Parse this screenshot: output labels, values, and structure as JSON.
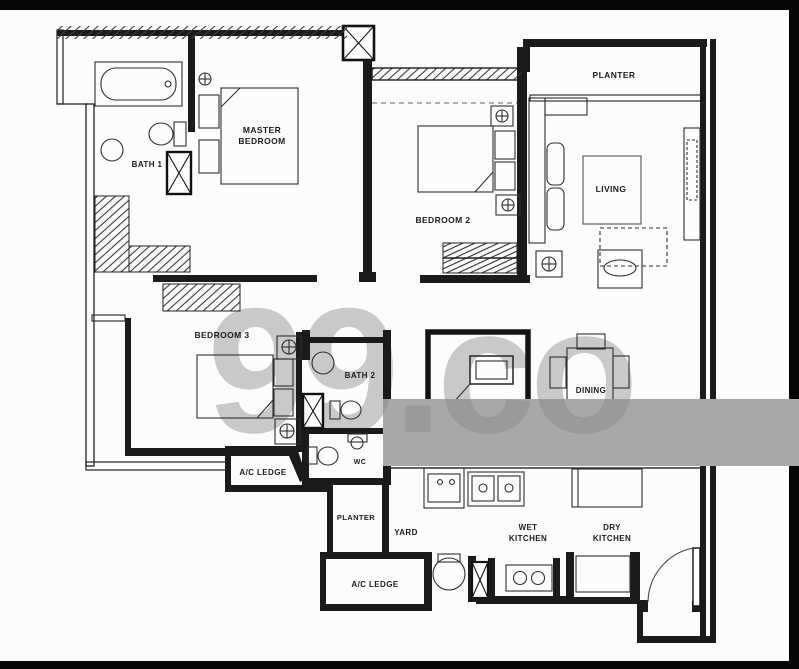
{
  "title": "apartment-floor-plan",
  "watermark": {
    "text": "99.co"
  },
  "colors": {
    "band": "#a9a9a9",
    "watermark_light": "#c9c9c9",
    "watermark_dark": "#9a9a9a",
    "wall": "#1b1b1b"
  },
  "labels": {
    "master_bedroom_1": "MASTER",
    "master_bedroom_2": "BEDROOM",
    "bath1": "BATH 1",
    "bedroom2": "BEDROOM 2",
    "planter_top": "PLANTER",
    "living": "LIVING",
    "bedroom3": "BEDROOM 3",
    "bath2": "BATH 2",
    "dining": "DINING",
    "ac_ledge_left": "A/C LEDGE",
    "wc": "WC",
    "planter_bottom": "PLANTER",
    "yard": "YARD",
    "wet_kitchen_1": "WET",
    "wet_kitchen_2": "KITCHEN",
    "dry_kitchen_1": "DRY",
    "dry_kitchen_2": "KITCHEN",
    "ac_ledge_bottom": "A/C LEDGE"
  }
}
